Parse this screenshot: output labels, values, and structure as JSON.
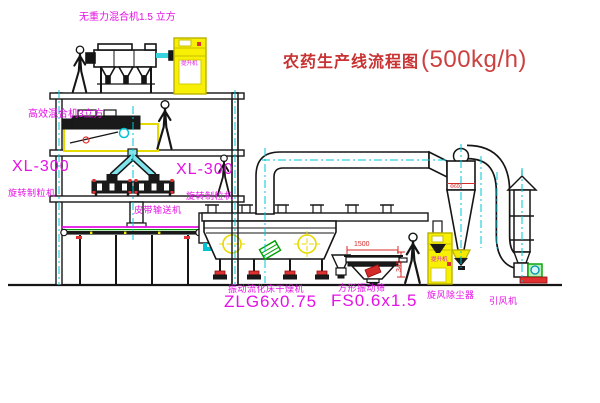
{
  "title": {
    "text": "农药生产线流程图",
    "capacity": "(500kg/h)"
  },
  "equipment_labels": {
    "gravity_mixer": "无重力混合机1.5 立方",
    "high_eff_mixer": "高效混合机3立方",
    "granulator_left_model": "XL-300",
    "granulator_left_name": "旋转制粒机",
    "granulator_right_model": "XL-300",
    "granulator_right_name": "旋转制粒机",
    "belt_conveyor": "皮带输送机",
    "dryer_name": "振动流化床干燥机",
    "dryer_model": "ZLG6x0.75",
    "sieve_name": "方形振动筛",
    "sieve_model": "FS0.6x1.5",
    "cyclone": "旋风除尘器",
    "fan": "引风机",
    "hoist_top": "提升机",
    "hoist_bottom": "提升机"
  },
  "dimensions": {
    "sieve_length": "1500",
    "sieve_height": "345",
    "cyclone_note": "Φ600"
  },
  "colors": {
    "label_magenta": "#e511e5",
    "title_red": "#c83232",
    "dimension_red": "#d42a2a",
    "centerline_cyan": "#00c4d4",
    "equipment_yellow": "#f7ef04",
    "line_black": "#151515",
    "accent_green": "#00a000"
  }
}
